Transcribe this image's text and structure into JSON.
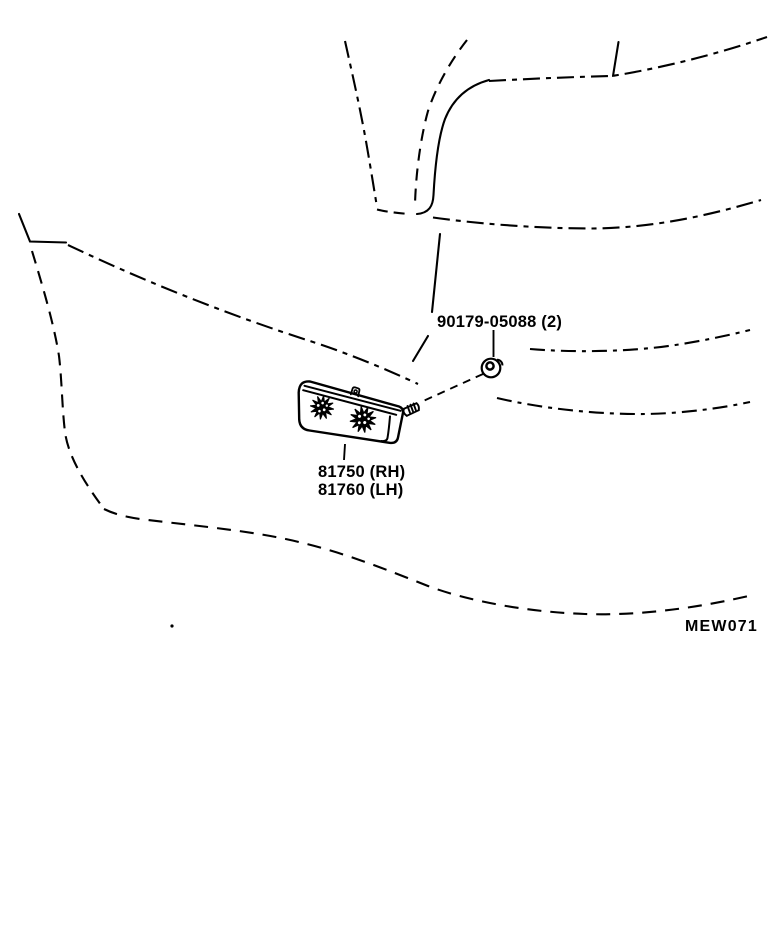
{
  "figure": {
    "code": "MEW071",
    "labels": {
      "screw": "90179-05088 (2)",
      "lamp_rh": "81750 (RH)",
      "lamp_lh": "81760 (LH)"
    },
    "parts": {
      "screw_grommet": "90179-05088",
      "side_marker_lamp_rh": "81750",
      "side_marker_lamp_lh": "81760"
    },
    "colors": {
      "ink": "#000000",
      "background": "#ffffff"
    }
  }
}
